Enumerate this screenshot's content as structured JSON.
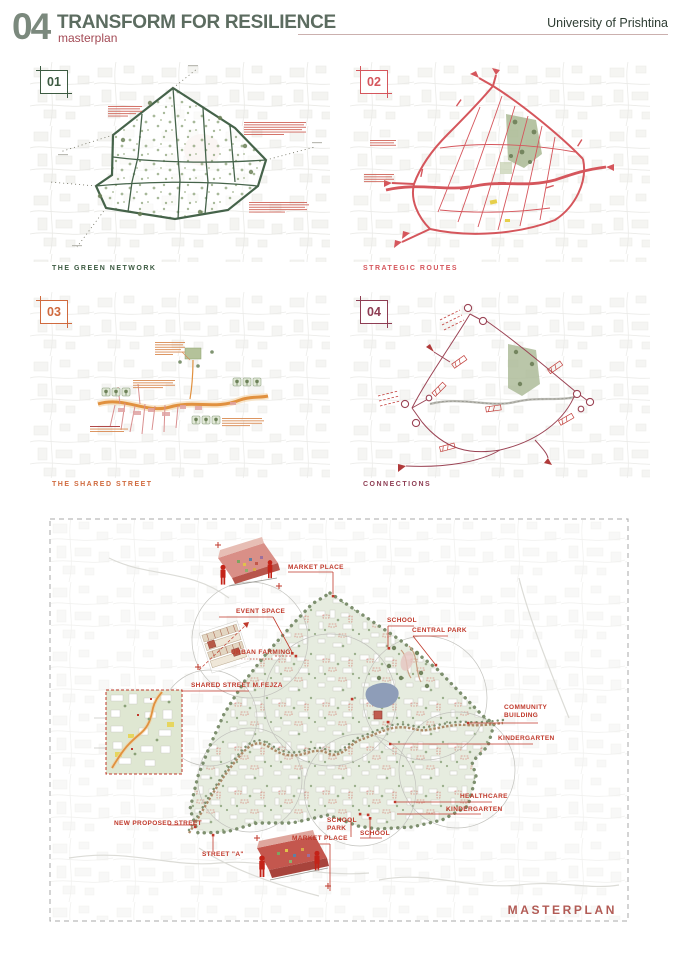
{
  "header": {
    "number": "04",
    "title": "TRANSFORM FOR RESILIENCE",
    "subtitle": "masterplan",
    "institution": "University of Prishtina"
  },
  "panels": [
    {
      "badge": "01",
      "caption": "THE GREEN NETWORK"
    },
    {
      "badge": "02",
      "caption": "STRATEGIC ROUTES"
    },
    {
      "badge": "03",
      "caption": "THE SHARED STREET"
    },
    {
      "badge": "04",
      "caption": "CONNECTIONS"
    }
  ],
  "masterplan": {
    "title": "MASTERPLAN",
    "labels": {
      "market_place_top": "MARKET PLACE",
      "event_space": "EVENT SPACE",
      "urban_farming": "URBAN FARMING",
      "shared_street": "SHARED STREET M.FEJZA",
      "school_top": "SCHOOL",
      "central_park": "CENTRAL PARK",
      "community_line1": "COMMUNITY",
      "community_line2": "BUILDING",
      "kindergarten_right": "KINDERGARTEN",
      "healthcare": "HEALTHCARE",
      "kindergarten_lower": "KINDERGARTEN",
      "school_park_line1": "SCHOOL",
      "school_park_line2": "PARK",
      "school_bottom": "SCHOOL",
      "market_place_bottom": "MARKET PLACE",
      "new_proposed_street": "NEW PROPOSED STREET",
      "street_a": "STREET \"A\""
    }
  },
  "colors": {
    "panel_green": "#3c5a41",
    "panel_red": "#d5565c",
    "panel_orange": "#d06a3e",
    "panel_maroon": "#8e3d53",
    "label_red": "#c0392b",
    "header_green": "#5c6c60",
    "header_number": "#7b897d",
    "header_sub_red": "#a34a55",
    "masterplan_title": "#b25b55"
  }
}
